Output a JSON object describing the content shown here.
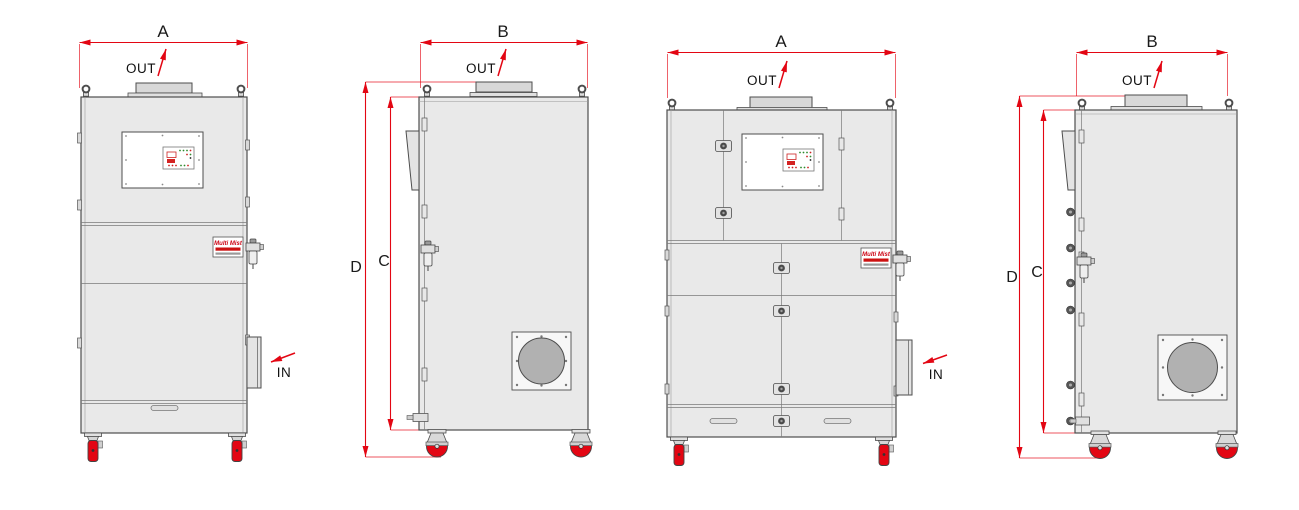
{
  "drawing": {
    "kind": "technical-dimension-drawing",
    "unit_views": 4,
    "colors": {
      "background": "#ffffff",
      "dimension_red": "#e30613",
      "outline_gray": "#4d4d4d",
      "cabinet_fill": "#e9e9e9",
      "duct_fill": "#d8d8d8",
      "fan_circle_fill": "#b1b1b1",
      "caster_wheel_red": "#e30613",
      "brand_red": "#cc0011"
    }
  },
  "brand": {
    "name": "Multi Mist"
  },
  "views": [
    {
      "name": "front-view-compact-unit",
      "width_dim": "A",
      "outlet": "OUT",
      "inlet": "IN"
    },
    {
      "name": "side-view-compact-unit",
      "depth_dim": "B",
      "outlet": "OUT",
      "overall_height_dim": "D",
      "body_height_dim": "C"
    },
    {
      "name": "front-view-wide-unit",
      "width_dim": "A",
      "outlet": "OUT",
      "inlet": "IN"
    },
    {
      "name": "side-view-wide-unit",
      "depth_dim": "B",
      "outlet": "OUT",
      "overall_height_dim": "D",
      "body_height_dim": "C"
    }
  ]
}
